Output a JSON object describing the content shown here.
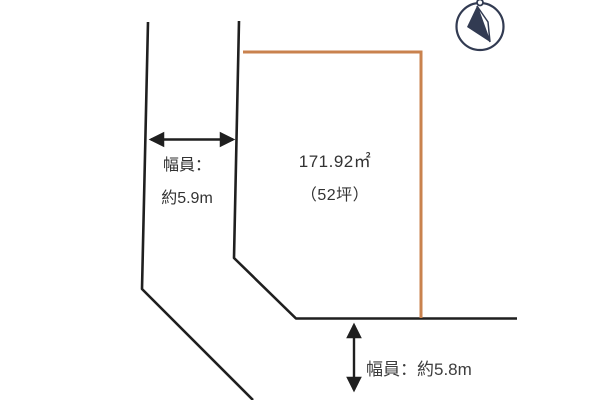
{
  "plot": {
    "area": "171.92㎡",
    "area_tsubo": "（52坪）"
  },
  "west_road": {
    "label_title": "幅員：",
    "label_value": "約5.9m"
  },
  "south_road": {
    "label": "幅員：約5.8m"
  },
  "compass": {
    "icon": "north-arrow"
  },
  "colors": {
    "road_line": "#1f1f1f",
    "plot_outline": "#c9824e",
    "text": "#333333",
    "compass": "#323b52"
  }
}
